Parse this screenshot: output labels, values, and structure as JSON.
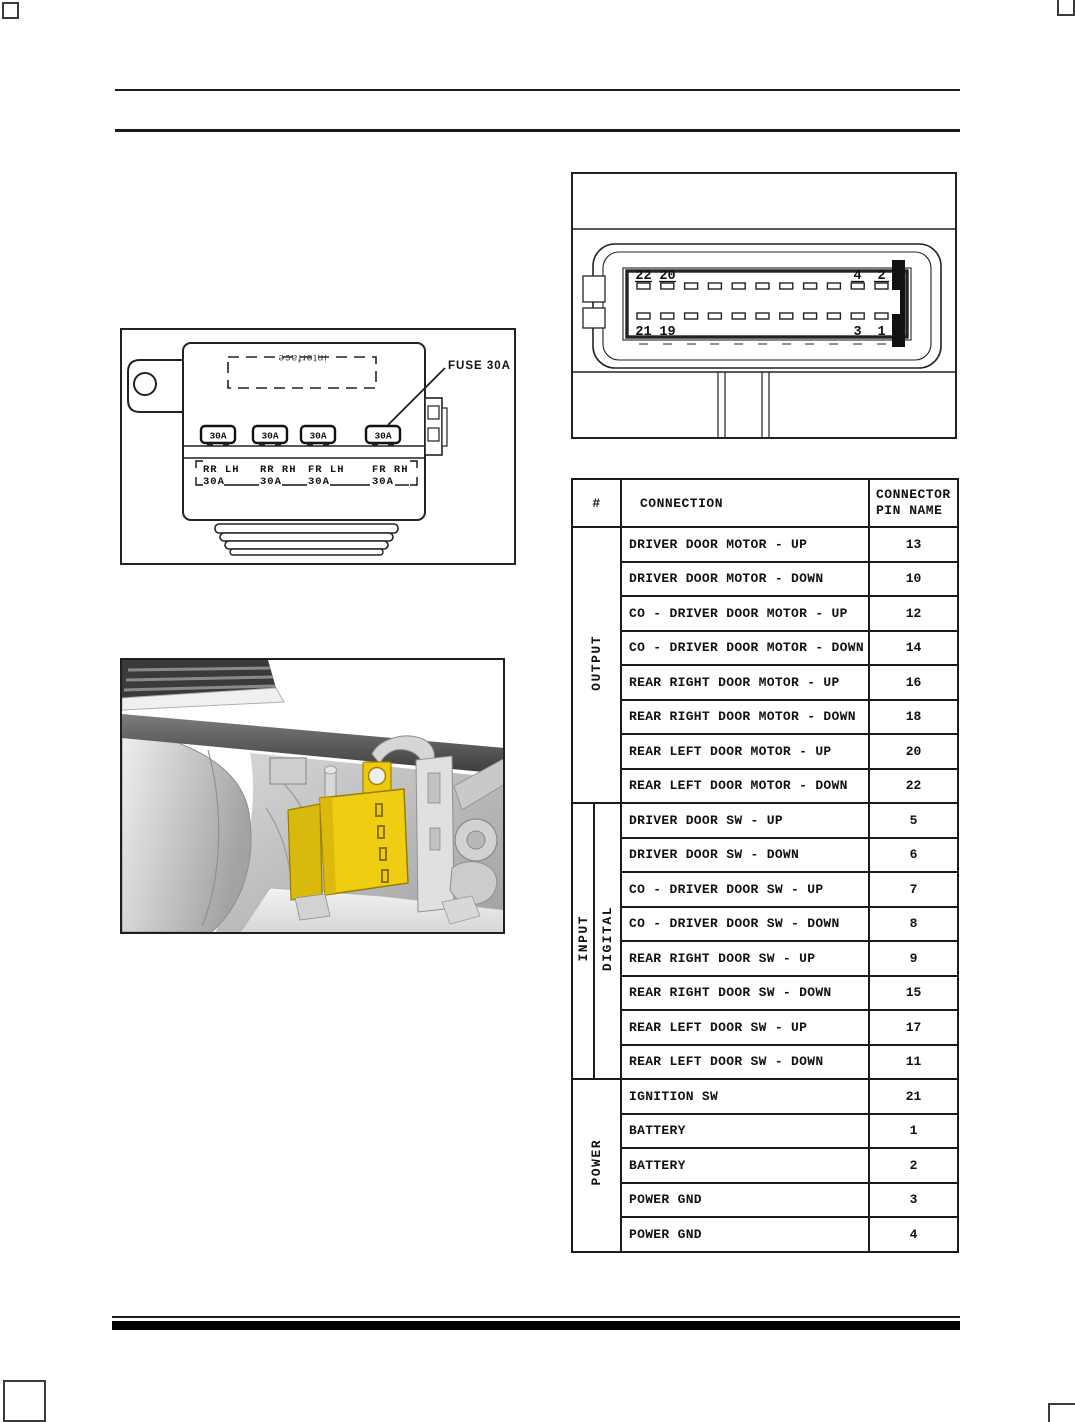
{
  "figures": {
    "fuse_module": {
      "pointer_label": "FUSE 30A",
      "mirrored_text": "interface",
      "fuse_amp": "30A",
      "circuits": [
        {
          "name": "RR LH",
          "amp": "30A"
        },
        {
          "name": "RR RH",
          "amp": "30A"
        },
        {
          "name": "FR LH",
          "amp": "30A"
        },
        {
          "name": "FR RH",
          "amp": "30A"
        }
      ]
    },
    "connector": {
      "pins_top": [
        "22",
        "20",
        "4",
        "2"
      ],
      "pins_bottom": [
        "21",
        "19",
        "3",
        "1"
      ]
    },
    "module_highlight_color": "#eecd12"
  },
  "pin_table": {
    "headers": [
      "#",
      "CONNECTION",
      "CONNECTOR PIN NAME"
    ],
    "groups": [
      {
        "label": "OUTPUT",
        "rows": [
          {
            "connection": "DRIVER DOOR MOTOR - UP",
            "pin": "13"
          },
          {
            "connection": "DRIVER DOOR MOTOR - DOWN",
            "pin": "10"
          },
          {
            "connection": "CO - DRIVER DOOR MOTOR - UP",
            "pin": "12"
          },
          {
            "connection": "CO - DRIVER DOOR MOTOR - DOWN",
            "pin": "14"
          },
          {
            "connection": "REAR RIGHT DOOR MOTOR - UP",
            "pin": "16"
          },
          {
            "connection": "REAR RIGHT DOOR MOTOR - DOWN",
            "pin": "18"
          },
          {
            "connection": "REAR LEFT DOOR MOTOR - UP",
            "pin": "20"
          },
          {
            "connection": "REAR LEFT DOOR MOTOR - DOWN",
            "pin": "22"
          }
        ]
      },
      {
        "label": "INPUT",
        "sublabel": "DIGITAL",
        "rows": [
          {
            "connection": "DRIVER DOOR SW - UP",
            "pin": "5"
          },
          {
            "connection": "DRIVER DOOR SW - DOWN",
            "pin": "6"
          },
          {
            "connection": "CO - DRIVER DOOR SW - UP",
            "pin": "7"
          },
          {
            "connection": "CO - DRIVER DOOR SW - DOWN",
            "pin": "8"
          },
          {
            "connection": "REAR RIGHT DOOR SW - UP",
            "pin": "9"
          },
          {
            "connection": "REAR RIGHT DOOR SW - DOWN",
            "pin": "15"
          },
          {
            "connection": "REAR LEFT DOOR SW - UP",
            "pin": "17"
          },
          {
            "connection": "REAR LEFT DOOR SW - DOWN",
            "pin": "11"
          }
        ]
      },
      {
        "label": "POWER",
        "rows": [
          {
            "connection": "IGNITION SW",
            "pin": "21"
          },
          {
            "connection": "BATTERY",
            "pin": "1"
          },
          {
            "connection": "BATTERY",
            "pin": "2"
          },
          {
            "connection": "POWER GND",
            "pin": "3"
          },
          {
            "connection": "POWER GND",
            "pin": "4"
          }
        ]
      }
    ]
  }
}
